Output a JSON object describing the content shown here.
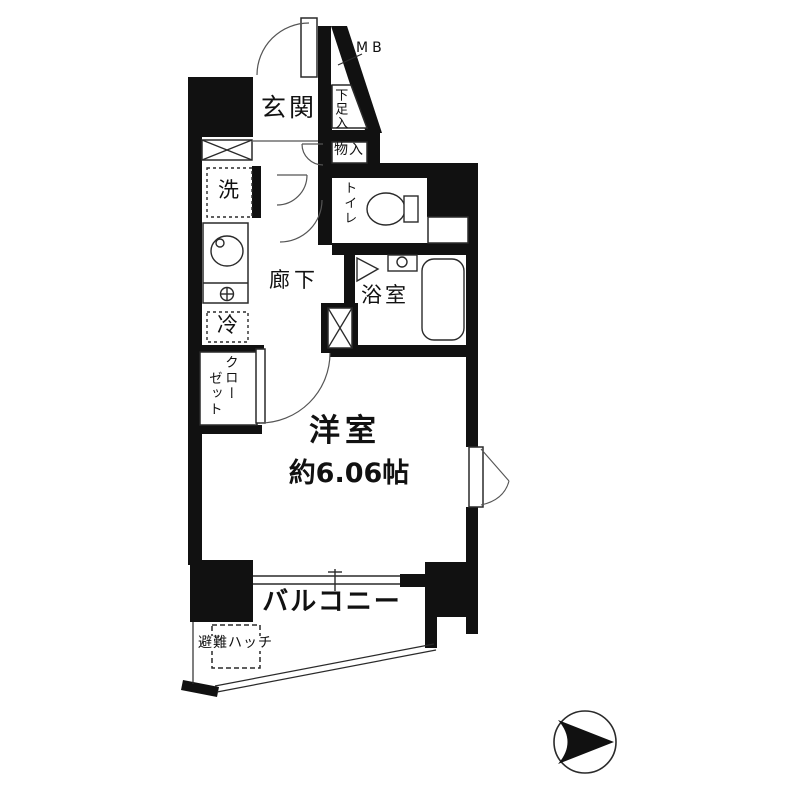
{
  "title": "apartment-floor-plan",
  "colors": {
    "wall": "#111111",
    "line": "#2a2a2a",
    "bg": "#ffffff"
  },
  "rooms": {
    "meter_box": "MB",
    "genkan": "玄関",
    "shoe_storage": "下足入",
    "storage": "物入",
    "washer": "洗",
    "toilet": "トイレ",
    "hallway": "廊下",
    "bathroom": "浴室",
    "refrigerator": "冷",
    "closet_line1": "クロー",
    "closet_line2": "ゼット",
    "western_room": "洋室",
    "western_room_size": "約6.06帖",
    "balcony": "バルコニー",
    "escape_hatch": "避難ハッチ"
  }
}
